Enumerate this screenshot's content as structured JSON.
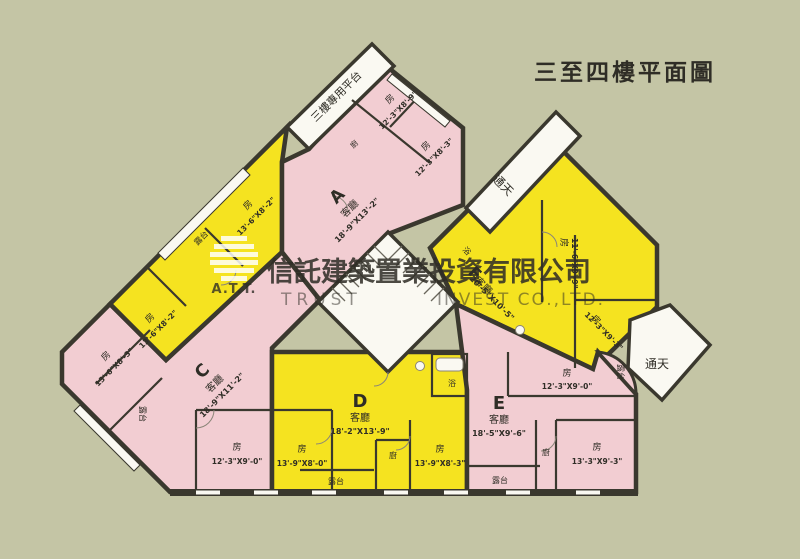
{
  "title": "三至四樓平面圖",
  "watermark": {
    "logo_text": "A.T.T.",
    "company_cn": "信託建築置業投資有限公司",
    "company_en_left": "TRUST",
    "company_en_right": "INVEST CO.,LTD."
  },
  "common_labels": {
    "platform": "三樓專用平台",
    "lightwell_top": "通天",
    "lightwell_bottom": "通天"
  },
  "units": {
    "A": {
      "id": "A",
      "living_label": "客廳",
      "living_dims": "18'-9\"X13'-2\"",
      "room1_label": "房",
      "room1_dims": "12'-3\"X8'-9\"",
      "room2_label": "房",
      "room2_dims": "12'-3\"X8'-3\"",
      "kitchen": "廚"
    },
    "B": {
      "room1_label": "房",
      "room1_dims": "13'-6\"X8'-2\"",
      "room2_label": "房",
      "room2_dims": "13'-6\"X8'-2\"",
      "balcony": "露台"
    },
    "C": {
      "id": "C",
      "living_label": "客廳",
      "living_dims": "18'-9\"X11'-2\"",
      "room1_label": "房",
      "room1_dims": "13'-6\"X8'-3\"",
      "room2_label": "房",
      "room2_dims": "12'-3\"X9'-0\"",
      "balcony": "露台"
    },
    "D": {
      "id": "D",
      "living_label": "客廳",
      "living_dims": "18'-2\"X13'-9\"",
      "room1_label": "房",
      "room1_dims": "13'-9\"X8'-0\"",
      "room2_label": "房",
      "room2_dims": "13'-9\"X8'-3\"",
      "kitchen": "廚",
      "bath": "浴",
      "balcony": "露台"
    },
    "E": {
      "id": "E",
      "living_label": "客廳",
      "living_dims": "18'-5\"X9'-6\"",
      "room1_label": "房",
      "room1_dims": "12'-3\"X9'-0\"",
      "room2_label": "房",
      "room2_dims": "13'-3\"X9'-3\"",
      "kitchen": "廚",
      "balcony_left": "露台",
      "balcony_right": "露台"
    },
    "F": {
      "id": "F",
      "living_label": "客廳",
      "living_dims": "20'-5\"X10'-5\"",
      "room1_label": "房",
      "room1_dims": "11'-6\"X9'-9\"",
      "room2_label": "房",
      "room2_dims": "12'-3\"X9'-3\"",
      "bath": "浴"
    }
  },
  "colors": {
    "background": "#c4c5a5",
    "unit_pink": "#f2cdd2",
    "unit_yellow": "#f5e320",
    "wall": "#3a382e",
    "paper_white": "#faf9f2",
    "watermark_white": "#ffffff"
  }
}
